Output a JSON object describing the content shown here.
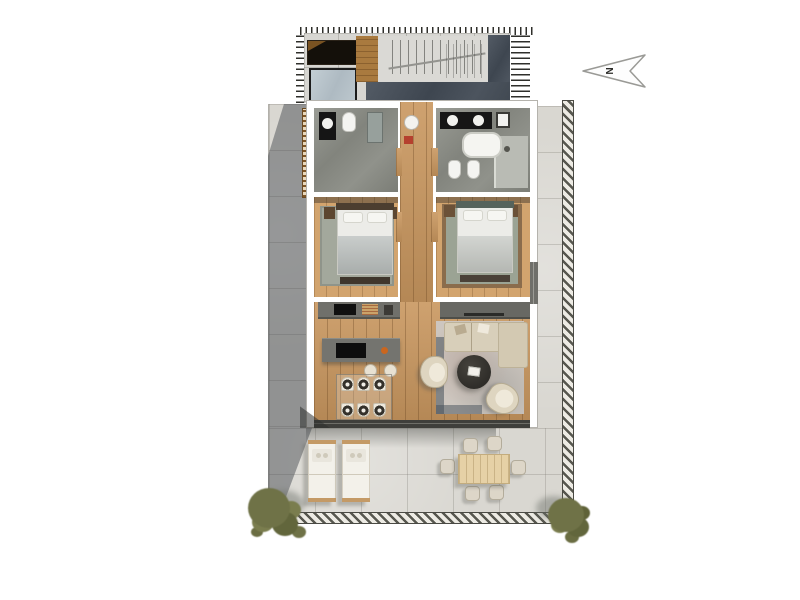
{
  "title": "Two-bedroom apartment floor plan, top-down 3D render",
  "north_arrow": {
    "label": "N"
  },
  "palette": {
    "background": "#ffffff",
    "terrace_tile": "#d9d7d1",
    "slate_dark": "#434b55",
    "wood_floor": "#c9975f",
    "wall_white": "#ffffff",
    "bathroom_marble": "#8b8d86",
    "counter_gray": "#70706b",
    "sofa_beige": "#d8cfba",
    "living_rug": "#cdc6bf",
    "bedroom_rug": "#a3a89c",
    "coffee_table": "#343129",
    "skylight_glass": "#b6c2c9",
    "louver_brown": "#7e5526",
    "bush_olive": "#6f7247",
    "outdoor_wood": "#e6d1a6",
    "accent_orange": "#c9661f",
    "accent_red": "#b5402e"
  },
  "counts": {
    "bedrooms": 2,
    "bathrooms": 2,
    "dining_chairs": 6,
    "place_settings": 6,
    "bar_stools": 2,
    "armchairs": 2,
    "sun_loungers": 2,
    "outdoor_chairs": 6,
    "plants": 2
  },
  "inventory": {
    "roof_terrace": [
      "staircase-with-railing",
      "skylight",
      "planter",
      "hatched-edge"
    ],
    "bathroom_left": [
      "vanity-sink",
      "toilet",
      "tall-cabinet"
    ],
    "bathroom_right": [
      "double-vanity",
      "corner-sink",
      "bathtub",
      "toilet",
      "bidet",
      "shower-area"
    ],
    "bedroom_left": [
      "double-bed",
      "nightstands",
      "rug",
      "foot-bench"
    ],
    "bedroom_right": [
      "double-bed",
      "nightstands",
      "rug",
      "foot-bench"
    ],
    "kitchen": [
      "wall-counter",
      "sink",
      "cutting-board",
      "island",
      "cooktop",
      "bar-stools"
    ],
    "dining": [
      "glass-table",
      "chairs",
      "place-settings"
    ],
    "living": [
      "tv-console",
      "corner-sofa",
      "round-coffee-table",
      "armchairs",
      "rug"
    ],
    "terrace": [
      "sun-loungers",
      "outdoor-dining-set",
      "railing",
      "plants",
      "louver-screens"
    ]
  }
}
